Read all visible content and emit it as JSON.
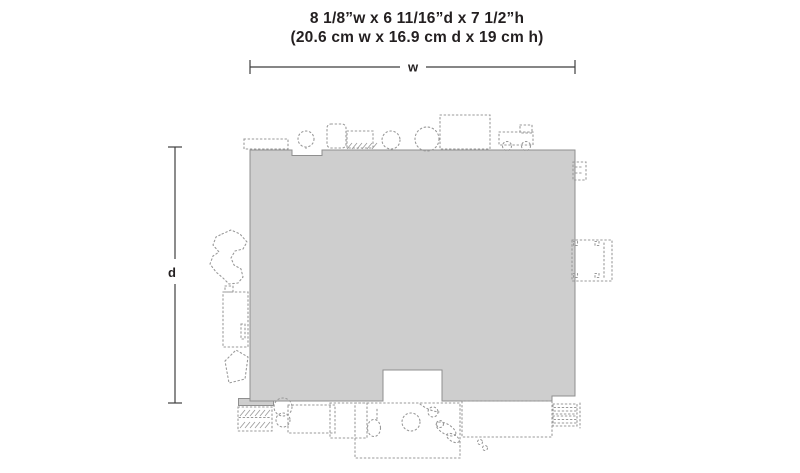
{
  "title": {
    "line1": "8 1/8”w x 6 11/16”d x 7 1/2”h",
    "line2": "(20.6 cm w x 16.9 cm d x 19 cm h)"
  },
  "dimension_labels": {
    "width": "w",
    "depth": "d"
  },
  "colors": {
    "footprint_fill": "#cecece",
    "footprint_outline": "#8f8f8f",
    "detail_outline": "#999999",
    "dimension_line": "#3f3f3f",
    "text_color": "#231f20",
    "page_bg": "#ffffff"
  }
}
